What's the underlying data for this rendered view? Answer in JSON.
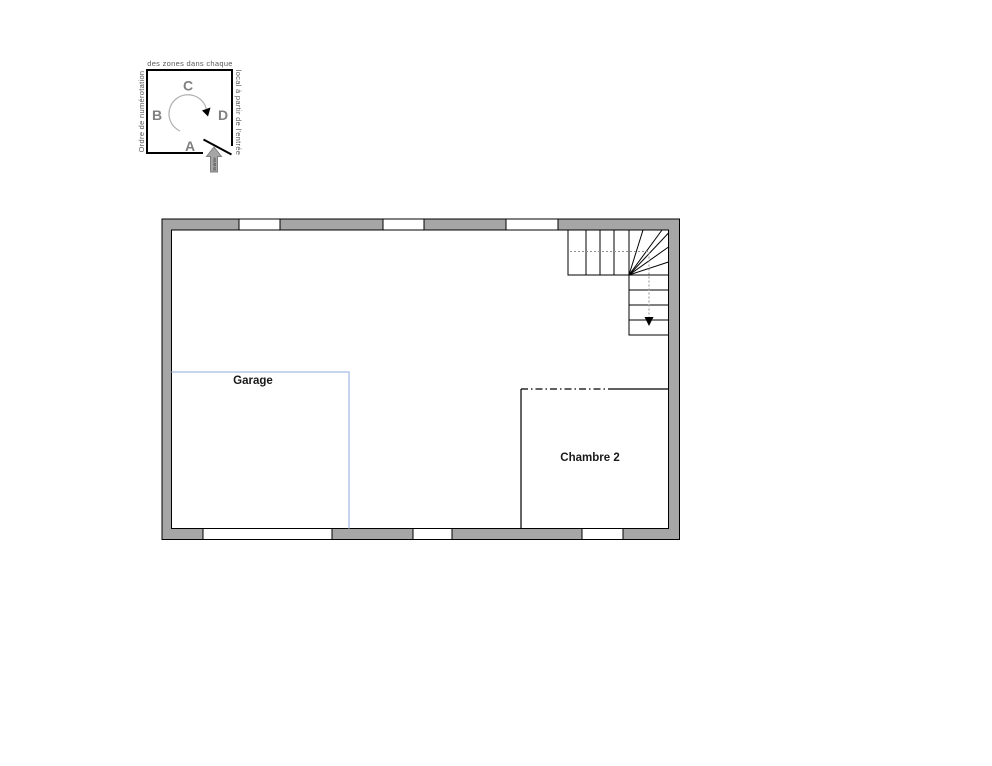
{
  "legend": {
    "caption_top": "des zones dans chaque",
    "caption_left": "Ordre de numérotation",
    "caption_right": "local à partir de l'entrée",
    "letters": {
      "A": "A",
      "B": "B",
      "C": "C",
      "D": "D"
    },
    "entrance_label": "Entrée"
  },
  "floor_plan": {
    "rooms": [
      {
        "name": "Garage"
      },
      {
        "name": "Chambre 2"
      }
    ]
  },
  "colors": {
    "wall_fill": "#a6a6a6",
    "room_outline_blue": "#b4c7e7",
    "legend_letter_gray": "#808080",
    "walkline_gray": "#909090"
  }
}
